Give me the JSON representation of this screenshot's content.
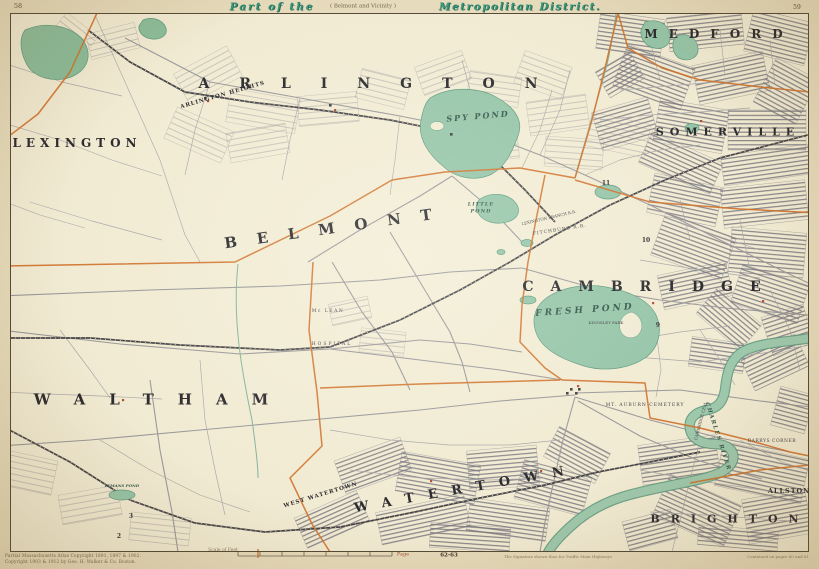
{
  "colors": {
    "paper": "#e7ddbf",
    "map_face": "#f3eed8",
    "water": "#93c6ab",
    "boundary": "#d06f28",
    "title_teal": "#2f9379",
    "urban_gray": "#7e7e8a"
  },
  "header": {
    "page_left": "58",
    "page_right": "59",
    "title_part": "Part of the",
    "title_bracket": "( Belmont and Vicinity )",
    "title_main": "Metropolitan District."
  },
  "towns": {
    "lexington": "LEXINGTON",
    "arlington": "ARLINGTON",
    "arlington_heights": "ARLINGTON HEIGHTS",
    "medford": "MEDFORD",
    "somerville": "SOMERVILLE",
    "cambridge": "CAMBRIDGE",
    "belmont": "BELMONT",
    "waltham": "WALTHAM",
    "watertown": "WATERTOWN",
    "west_watertown": "WEST WATERTOWN",
    "brighton": "BRIGHTON",
    "allston": "ALLSTON",
    "barrys_corner": "BARRYS CORNER"
  },
  "water_labels": {
    "spy_pond": "SPY POND",
    "little_pond_1": "LITTLE",
    "little_pond_2": "POND",
    "fresh_pond": "FRESH POND",
    "charles_river": "CHARLES RIVER",
    "lymans_pond": "LYMANS POND"
  },
  "places": {
    "kingsley_park": "KINGSLEY PARK",
    "mt_auburn": "MT. AUBURN CEMETERY",
    "cambridge_cem": "CAMBRIDGE CEM.",
    "mclean_1": "Mc LEAN",
    "mclean_2": "HOSPITAL"
  },
  "railroads": {
    "fitchburg": "FITCHBURG R.R.",
    "lexington_branch": "LEXINGTON BRANCH R.R."
  },
  "district_numbers": [
    "11",
    "10",
    "9",
    "3",
    "2"
  ],
  "footer": {
    "credit1": "Partial Massachusetts Atlas Copyright 1891, 1897 & 1902.",
    "credit2": "Copyright 1903 & 1912 by Geo. H. Walker & Co. Boston.",
    "scale_label": "Scale of Feet",
    "page_label": "Page",
    "page_ref": "62-63",
    "note_center": "The Signature shown thus for Traffic Main Highways",
    "note_right": "Continued on pages 60 and 61"
  }
}
